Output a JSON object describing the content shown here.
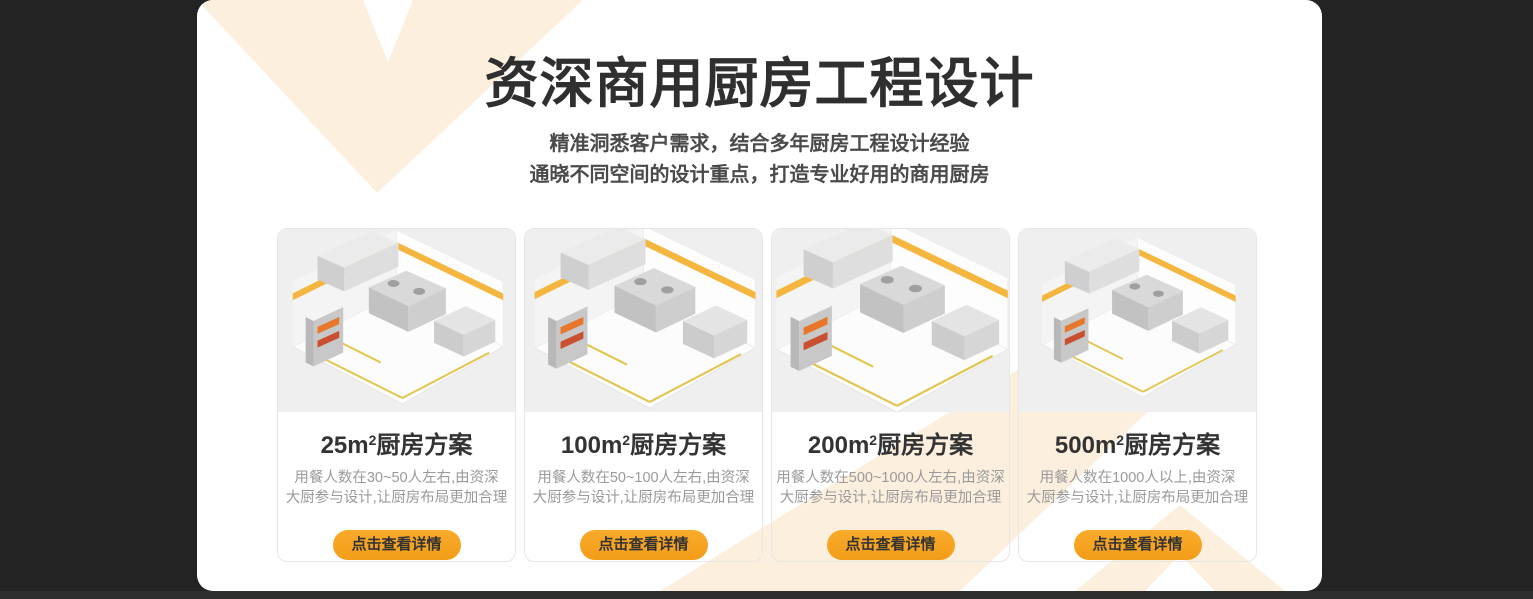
{
  "page": {
    "background_color": "#232323",
    "panel_color": "#ffffff",
    "decoration_color": "#fcefde",
    "accent_color": "#f7a424",
    "bottom_strip_color": "#2e2e2e"
  },
  "header": {
    "title": "资深商用厨房工程设计",
    "subtitle_line1": "精准洞悉客户需求，结合多年厨房工程设计经验",
    "subtitle_line2": "通晓不同空间的设计重点，打造专业好用的商用厨房"
  },
  "cards": [
    {
      "area": "25m",
      "area_sup": "2",
      "title_suffix": "厨房方案",
      "desc_line1": "用餐人数在30~50人左右,由资深",
      "desc_line2": "大厨参与设计,让厨房布局更加合理",
      "button_label": "点击查看详情"
    },
    {
      "area": "100m",
      "area_sup": "2",
      "title_suffix": "厨房方案",
      "desc_line1": "用餐人数在50~100人左右,由资深",
      "desc_line2": "大厨参与设计,让厨房布局更加合理",
      "button_label": "点击查看详情"
    },
    {
      "area": "200m",
      "area_sup": "2",
      "title_suffix": "厨房方案",
      "desc_line1": "用餐人数在500~1000人左右,由资深",
      "desc_line2": "大厨参与设计,让厨房布局更加合理",
      "button_label": "点击查看详情"
    },
    {
      "area": "500m",
      "area_sup": "2",
      "title_suffix": "厨房方案",
      "desc_line1": "用餐人数在1000人以上,由资深",
      "desc_line2": "大厨参与设计,让厨房布局更加合理",
      "button_label": "点击查看详情"
    }
  ]
}
